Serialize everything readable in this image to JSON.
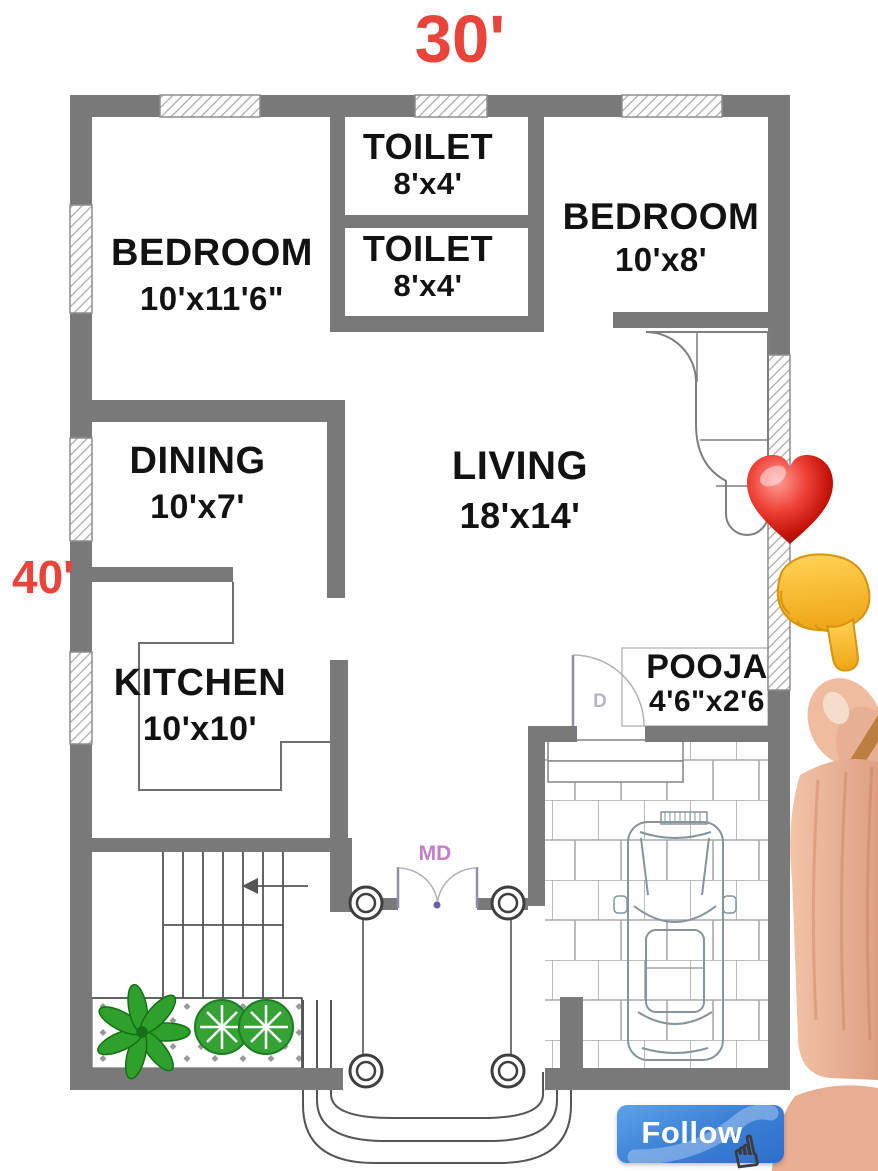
{
  "dimensions": {
    "width_label": "30'",
    "height_label": "40'"
  },
  "rooms": {
    "bedroom1": {
      "name": "BEDROOM",
      "size": "10'x11'6\""
    },
    "toilet1": {
      "name": "TOILET",
      "size": "8'x4'"
    },
    "toilet2": {
      "name": "TOILET",
      "size": "8'x4'"
    },
    "bedroom2": {
      "name": "BEDROOM",
      "size": "10'x8'"
    },
    "dining": {
      "name": "DINING",
      "size": "10'x7'"
    },
    "living": {
      "name": "LIVING",
      "size": "18'x14'"
    },
    "kitchen": {
      "name": "KITCHEN",
      "size": "10'x10'"
    },
    "pooja": {
      "name": "POOJA",
      "size": "4'6\"x2'6"
    }
  },
  "doors": {
    "main_door_label": "MD",
    "door_label": "D"
  },
  "follow": {
    "label": "Follow"
  },
  "icons": {
    "heart": "red-heart-emoji",
    "pointing": "backhand-index-pointing-down-emoji",
    "cursor": "hand-cursor",
    "cursor_glyph": "☝"
  },
  "colors": {
    "wall_gray": "#797979",
    "dimension_red": "#e8443b",
    "follow_blue": "#3c82d8",
    "md_purple": "#c47fc9",
    "plant_green": "#2fa02c",
    "emoji_yellow": "#f5b72e",
    "heart_red": "#c51309"
  }
}
